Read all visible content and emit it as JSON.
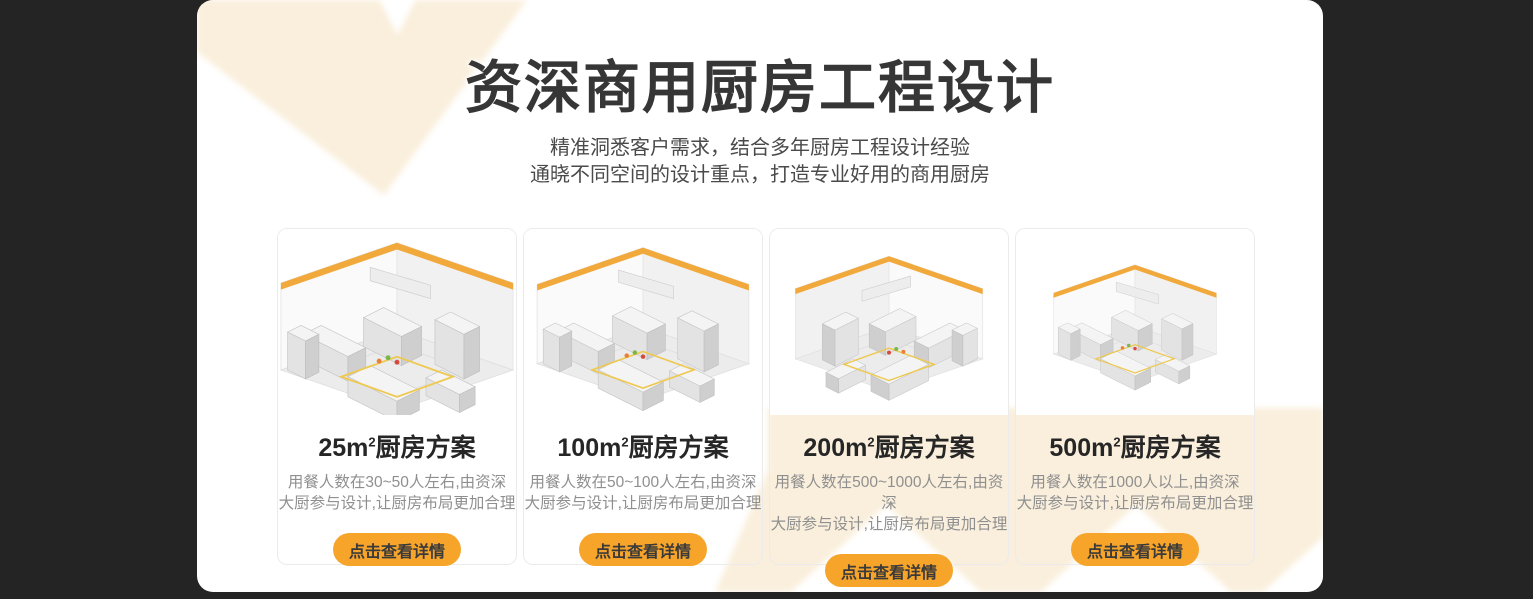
{
  "theme": {
    "background_color": "#242424",
    "panel_color": "#ffffff",
    "decor_cream_color": "#faefdc",
    "accent_orange_color": "#f7a42a"
  },
  "header": {
    "title": "资深商用厨房工程设计",
    "subtitle_line1": "精准洞悉客户需求，结合多年厨房工程设计经验",
    "subtitle_line2": "通晓不同空间的设计重点，打造专业好用的商用厨房"
  },
  "cards": [
    {
      "title_prefix": "25m",
      "title_sup": "2",
      "title_suffix": "厨房方案",
      "desc_line1": "用餐人数在30~50人左右,由资深",
      "desc_line2": "大厨参与设计,让厨房布局更加合理",
      "button_label": "点击查看详情"
    },
    {
      "title_prefix": "100m",
      "title_sup": "2",
      "title_suffix": "厨房方案",
      "desc_line1": "用餐人数在50~100人左右,由资深",
      "desc_line2": "大厨参与设计,让厨房布局更加合理",
      "button_label": "点击查看详情"
    },
    {
      "title_prefix": "200m",
      "title_sup": "2",
      "title_suffix": "厨房方案",
      "desc_line1": "用餐人数在500~1000人左右,由资深",
      "desc_line2": "大厨参与设计,让厨房布局更加合理",
      "button_label": "点击查看详情"
    },
    {
      "title_prefix": "500m",
      "title_sup": "2",
      "title_suffix": "厨房方案",
      "desc_line1": "用餐人数在1000人以上,由资深",
      "desc_line2": "大厨参与设计,让厨房布局更加合理",
      "button_label": "点击查看详情"
    }
  ]
}
